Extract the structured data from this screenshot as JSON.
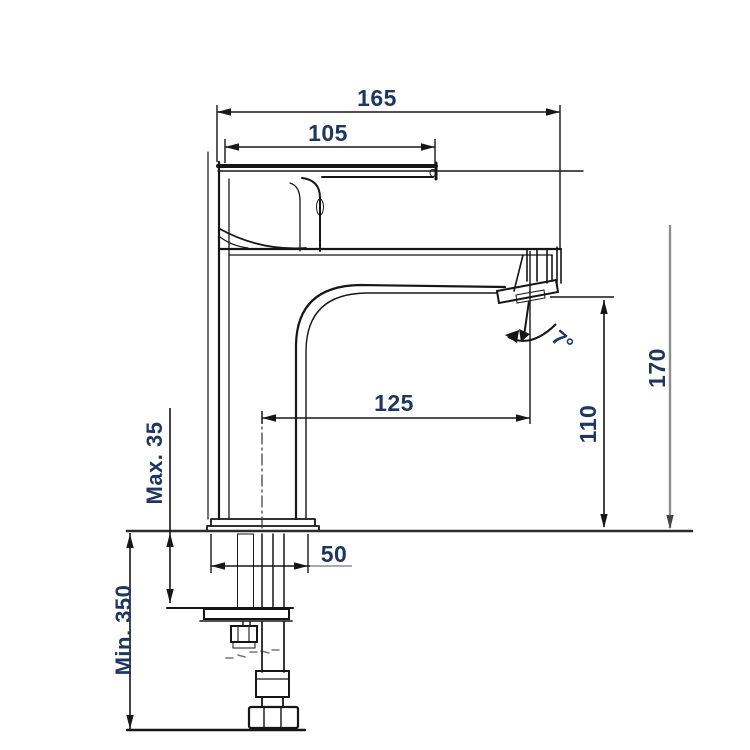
{
  "labels": {
    "dim_total_length": "165",
    "dim_handle_length": "105",
    "dim_spout_reach": "125",
    "dim_spout_height": "110",
    "dim_overall_height": "170",
    "dim_base_width": "50",
    "dim_deck_thickness": "Max. 35",
    "dim_hose_length": "Min. 350",
    "dim_aerator_angle": "7°"
  },
  "colors": {
    "line": "#161616",
    "dim_text": "#1c3760",
    "gray_line": "#8f8f8f",
    "background": "#ffffff"
  }
}
